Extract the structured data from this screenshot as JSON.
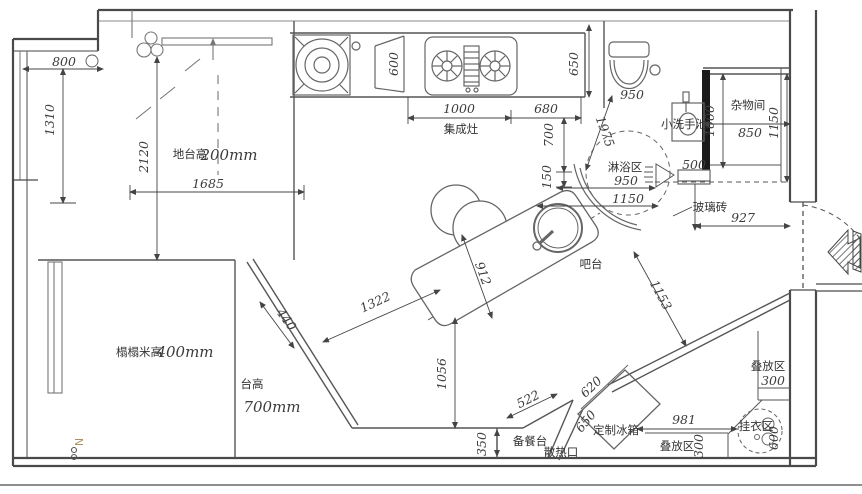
{
  "plan": {
    "labels": {
      "platform": "地台高",
      "platform_value": "200mm",
      "tatami": "榻榻米高",
      "tatami_value": "400mm",
      "counter": "台高",
      "counter_value": "700mm",
      "stove": "集成灶",
      "basin": "小洗手池",
      "storage": "杂物间",
      "shower": "淋浴区",
      "glass_brick": "玻璃砖",
      "bar": "吧台",
      "prep": "备餐台",
      "vent": "散热口",
      "fridge": "定制冰箱",
      "stack_upper": "叠放区",
      "stack_lower": "叠放区",
      "hang": "挂衣区",
      "north": "N"
    },
    "dimensions": {
      "d800": "800",
      "d1310": "1310",
      "d2120": "2120",
      "d1685": "1685",
      "d600_cabinet": "600",
      "d1000_stove": "1000",
      "d680": "680",
      "d650_kitchen": "650",
      "d700": "700",
      "d150": "150",
      "d950_toilet": "950",
      "d1000_storage": "1000",
      "d850": "850",
      "d1150_storage": "1150",
      "d1975": "1975",
      "d950_shower": "950",
      "d1150_shower": "1150",
      "d500": "500",
      "d927": "927",
      "d912": "912",
      "d1153": "1153",
      "d440": "440",
      "d1322": "1322",
      "d1056": "1056",
      "d350": "350",
      "d522": "522",
      "d620": "620",
      "d650_fridge": "650",
      "d981": "981",
      "d300_upper": "300",
      "d300_lower": "300",
      "d600_hang": "600"
    }
  }
}
